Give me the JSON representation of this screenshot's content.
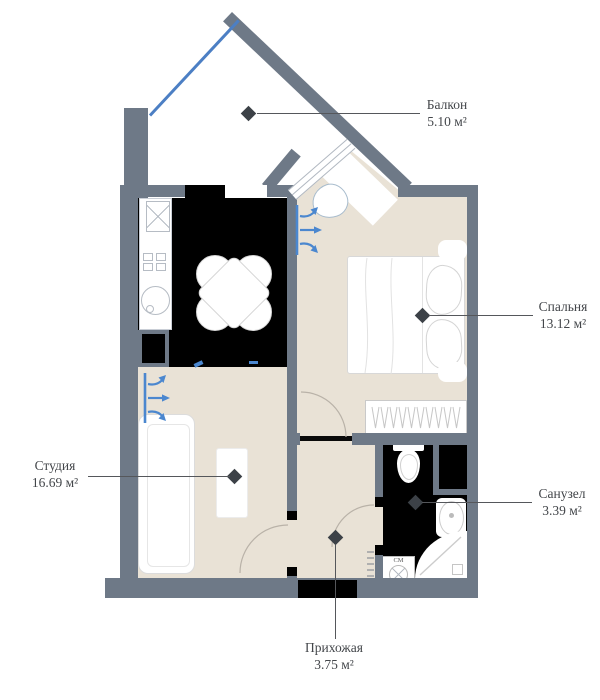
{
  "plan_title": "apartment-floor-plan",
  "rooms": {
    "balcony": {
      "name": "Балкон",
      "area": "5.10 м²"
    },
    "bedroom": {
      "name": "Спальня",
      "area": "13.12 м²"
    },
    "bathroom": {
      "name": "Санузел",
      "area": "3.39 м²"
    },
    "studio": {
      "name": "Студия",
      "area": "16.69 м²"
    },
    "hallway": {
      "name": "Прихожая",
      "area": "3.75 м²"
    }
  },
  "appliances": {
    "washing_machine_label": "СМ"
  },
  "colors": {
    "wall": "#6e7987",
    "floor": "#e9e2d6",
    "dark_room": "#000000",
    "accent_blue": "#4b87cf",
    "window_blue": "#4c7fc4",
    "label_text": "#43464a",
    "furniture_outline": "#d6d6d6"
  }
}
